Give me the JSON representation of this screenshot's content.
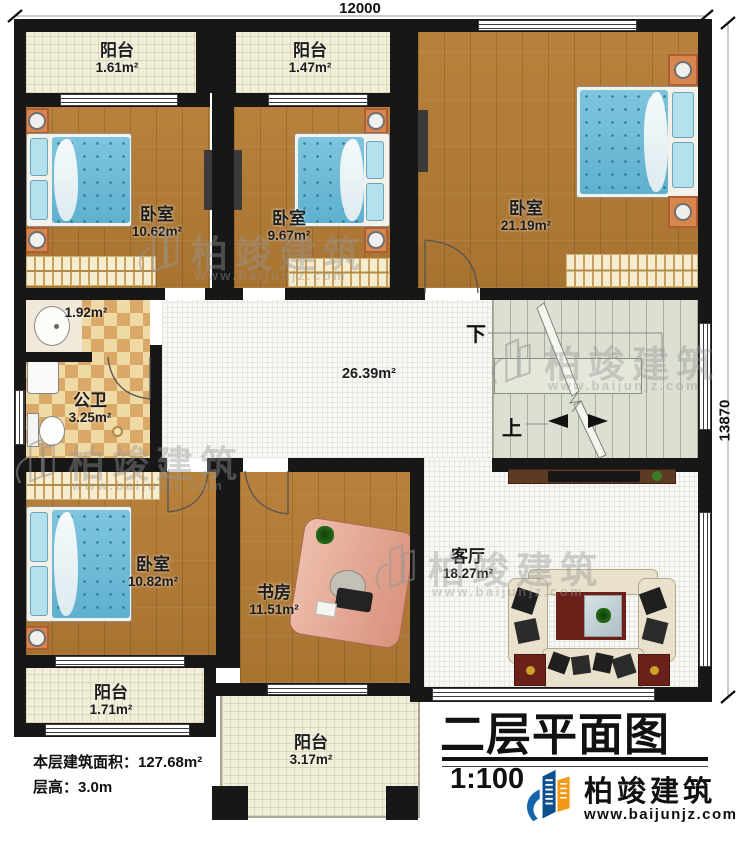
{
  "dimensions": {
    "top": "12000",
    "right": "13870"
  },
  "rooms": {
    "balcony_top_left": {
      "name": "阳台",
      "area": "1.61m²"
    },
    "balcony_top_mid": {
      "name": "阳台",
      "area": "1.47m²"
    },
    "bedroom_top_left": {
      "name": "卧室",
      "area": "10.62m²"
    },
    "bedroom_top_mid": {
      "name": "卧室",
      "area": "9.67m²"
    },
    "bedroom_top_right": {
      "name": "卧室",
      "area": "21.19m²"
    },
    "bath_vanity": {
      "area": "1.92m²"
    },
    "bathroom": {
      "name": "公卫",
      "area": "3.25m²"
    },
    "hallway": {
      "area": "26.39m²"
    },
    "bedroom_bottom_left": {
      "name": "卧室",
      "area": "10.82m²"
    },
    "study": {
      "name": "书房",
      "area": "11.51m²"
    },
    "living_room": {
      "name": "客厅",
      "area": "18.27m²"
    },
    "balcony_bottom_left": {
      "name": "阳台",
      "area": "1.71m²"
    },
    "balcony_bottom_mid": {
      "name": "阳台",
      "area": "3.17m²"
    }
  },
  "stairs": {
    "down": "下",
    "up": "上"
  },
  "title": {
    "text": "二层平面图",
    "scale": "1:100"
  },
  "footer": {
    "floor_area": "本层建筑面积：127.68m²",
    "floor_height": "层高：3.0m"
  },
  "brand": {
    "name": "柏竣建筑",
    "url": "www.baijunjz.com"
  },
  "watermark": {
    "name": "柏竣建筑",
    "url": "www.baijunjz.com"
  },
  "colors": {
    "wall": "#171717",
    "wood": "#b07a35",
    "balcony_tile": "#f1eed9",
    "bath_tile_light": "#efd9a4",
    "bath_tile_dark": "#dba967",
    "stair": "#dbe0d2",
    "bed_blue": "#6fbcd6",
    "brand_blue": "#1565ad",
    "brand_orange": "#f09a18"
  }
}
